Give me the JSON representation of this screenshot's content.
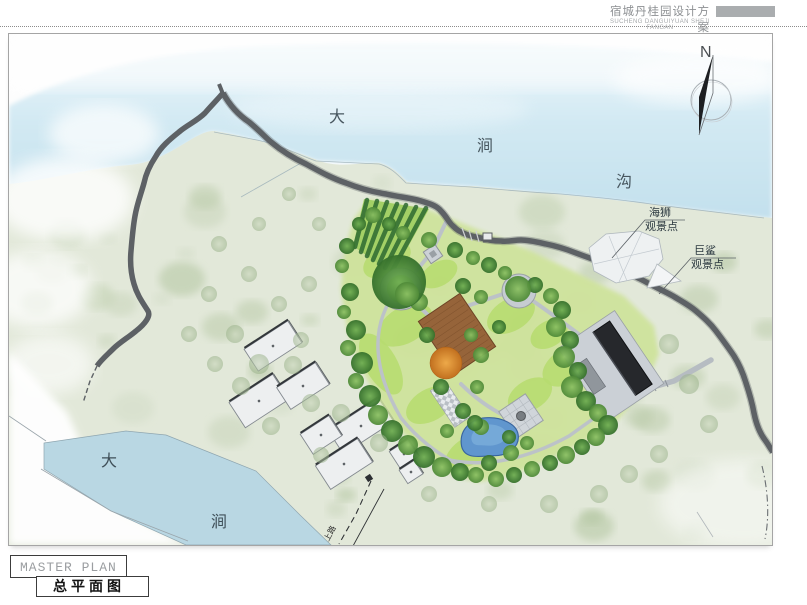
{
  "header": {
    "title": "宿城丹桂园设计方案",
    "subtitle": "SUCHENG DANGUIYUAN SHEJI FANGAN"
  },
  "compass": {
    "north": "N"
  },
  "map": {
    "stream_labels": {
      "da": "大",
      "jian": "涧",
      "gou": "沟"
    },
    "river_labels": {
      "da": "大",
      "jian": "涧"
    },
    "viewpoints": [
      {
        "name": "海狮",
        "type": "观景点"
      },
      {
        "name": "巨鲨",
        "type": "观景点"
      }
    ],
    "trail_label": "上路"
  },
  "titleblock": {
    "en": "MASTER PLAN",
    "zh": "总平面图"
  },
  "colors": {
    "water": "#cde7f2",
    "river": "#b9d7e3",
    "pond": "#6096ce",
    "road": "#5d6165",
    "terrain": "#e2e8d9",
    "lawn": "#b7db70",
    "deck": "#96643a",
    "dark_roof": "#26282c",
    "village_building": "#edeff0",
    "autumn_tree": "#d9822e"
  }
}
